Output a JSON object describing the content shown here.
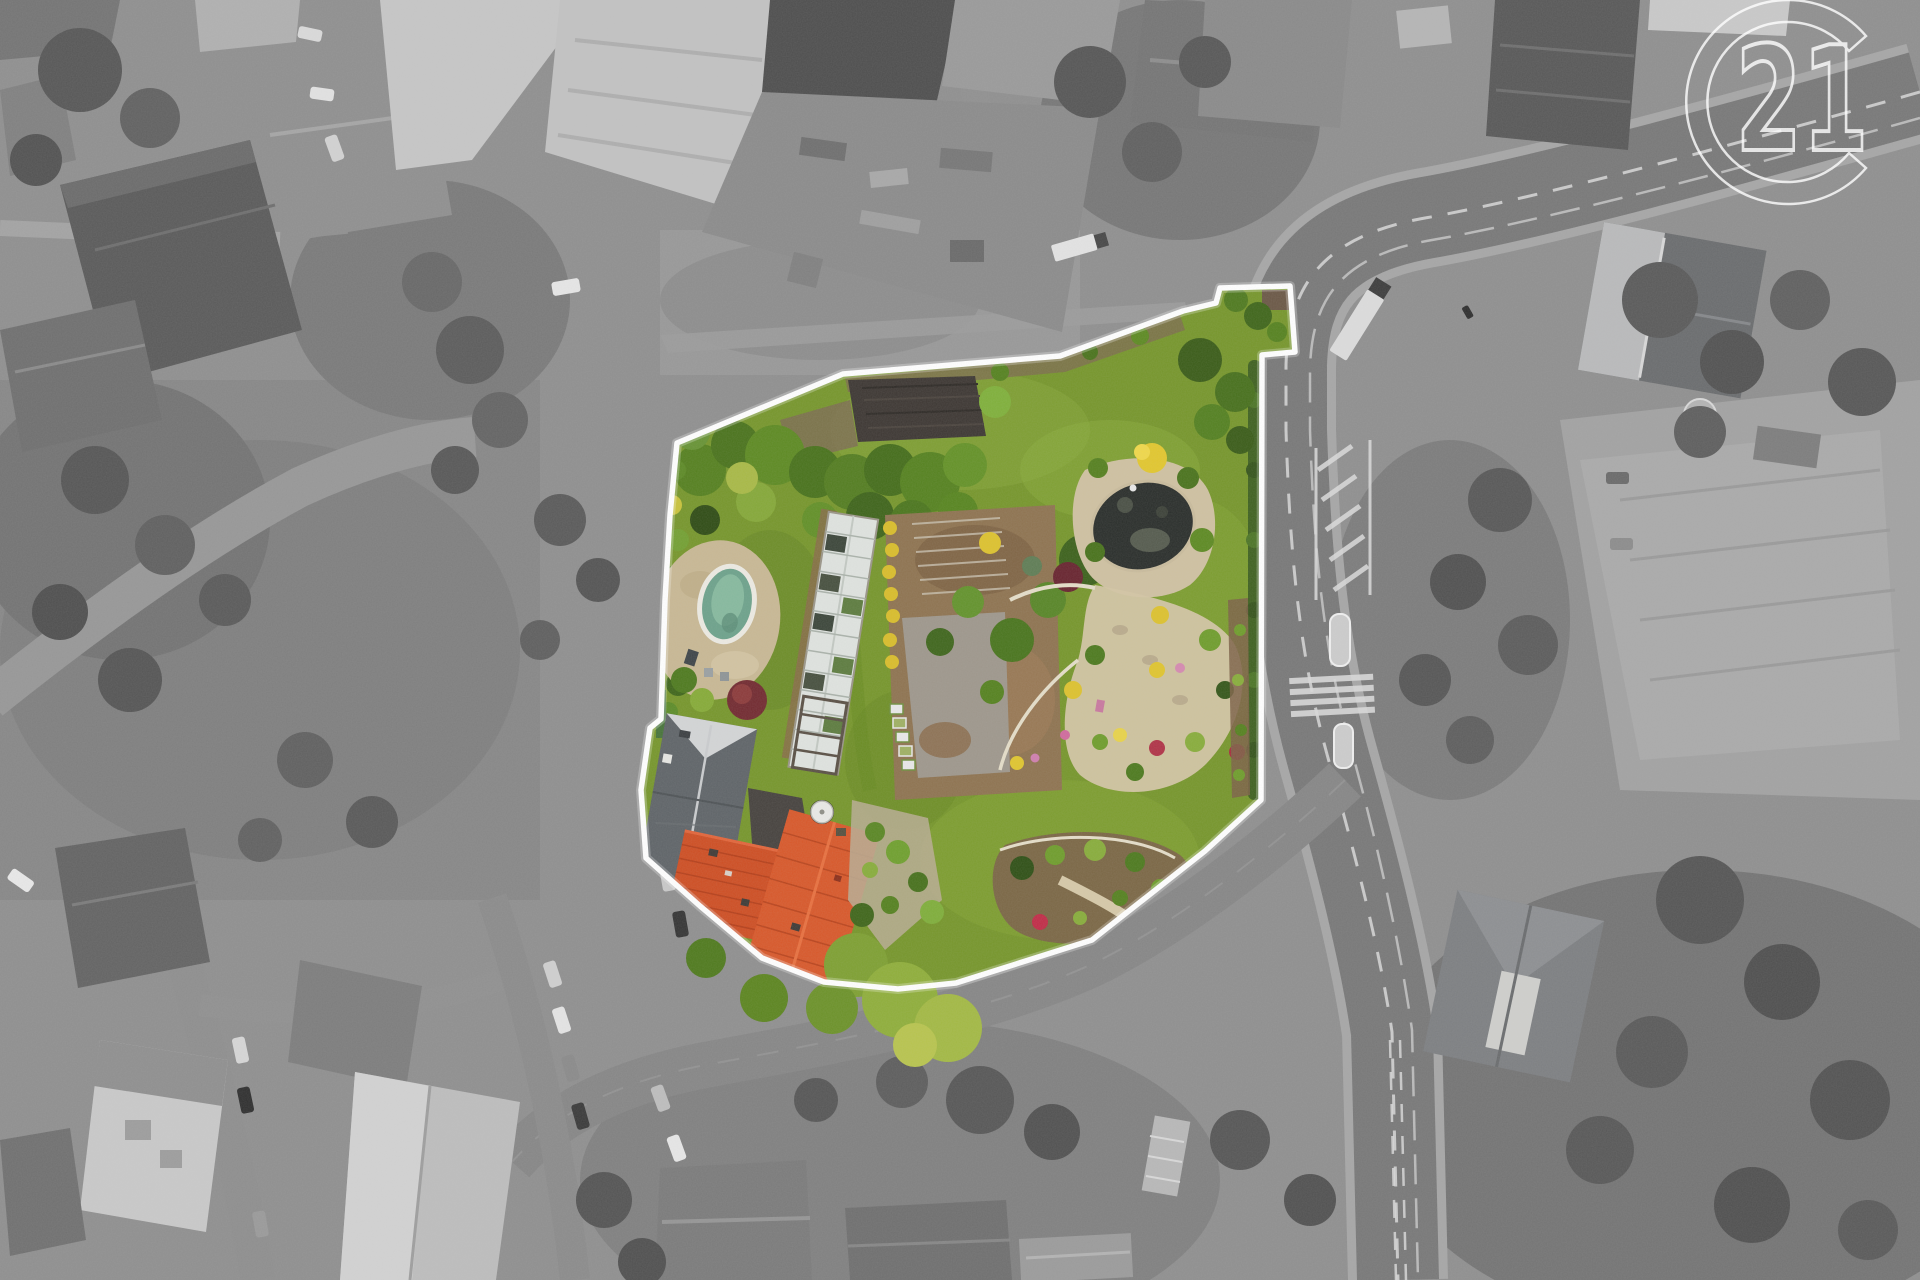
{
  "watermark": {
    "text": "21",
    "color": "#ffffff",
    "brand": "century-21-logo"
  },
  "palette": {
    "grayscale_base": "#8f8f8f",
    "road_gray": "#7b7b7b",
    "lawn": "#76962b",
    "lawn_light": "#8aa93c",
    "tree_green": "#4c7520",
    "pool_water": "#6da28b",
    "pool_rim": "#eceae2",
    "pond_water": "#2a2e2b",
    "gravel_beige": "#cfc1a1",
    "soil_brown": "#8e7350",
    "greenhouse_white": "#dfe3df",
    "roof_red_main": "#ce4e23",
    "roof_red_second": "#d8582a",
    "gray_barn_roof": "#5f6468",
    "boundary": "#ffffff",
    "marking_white": "#e0e0e0"
  }
}
